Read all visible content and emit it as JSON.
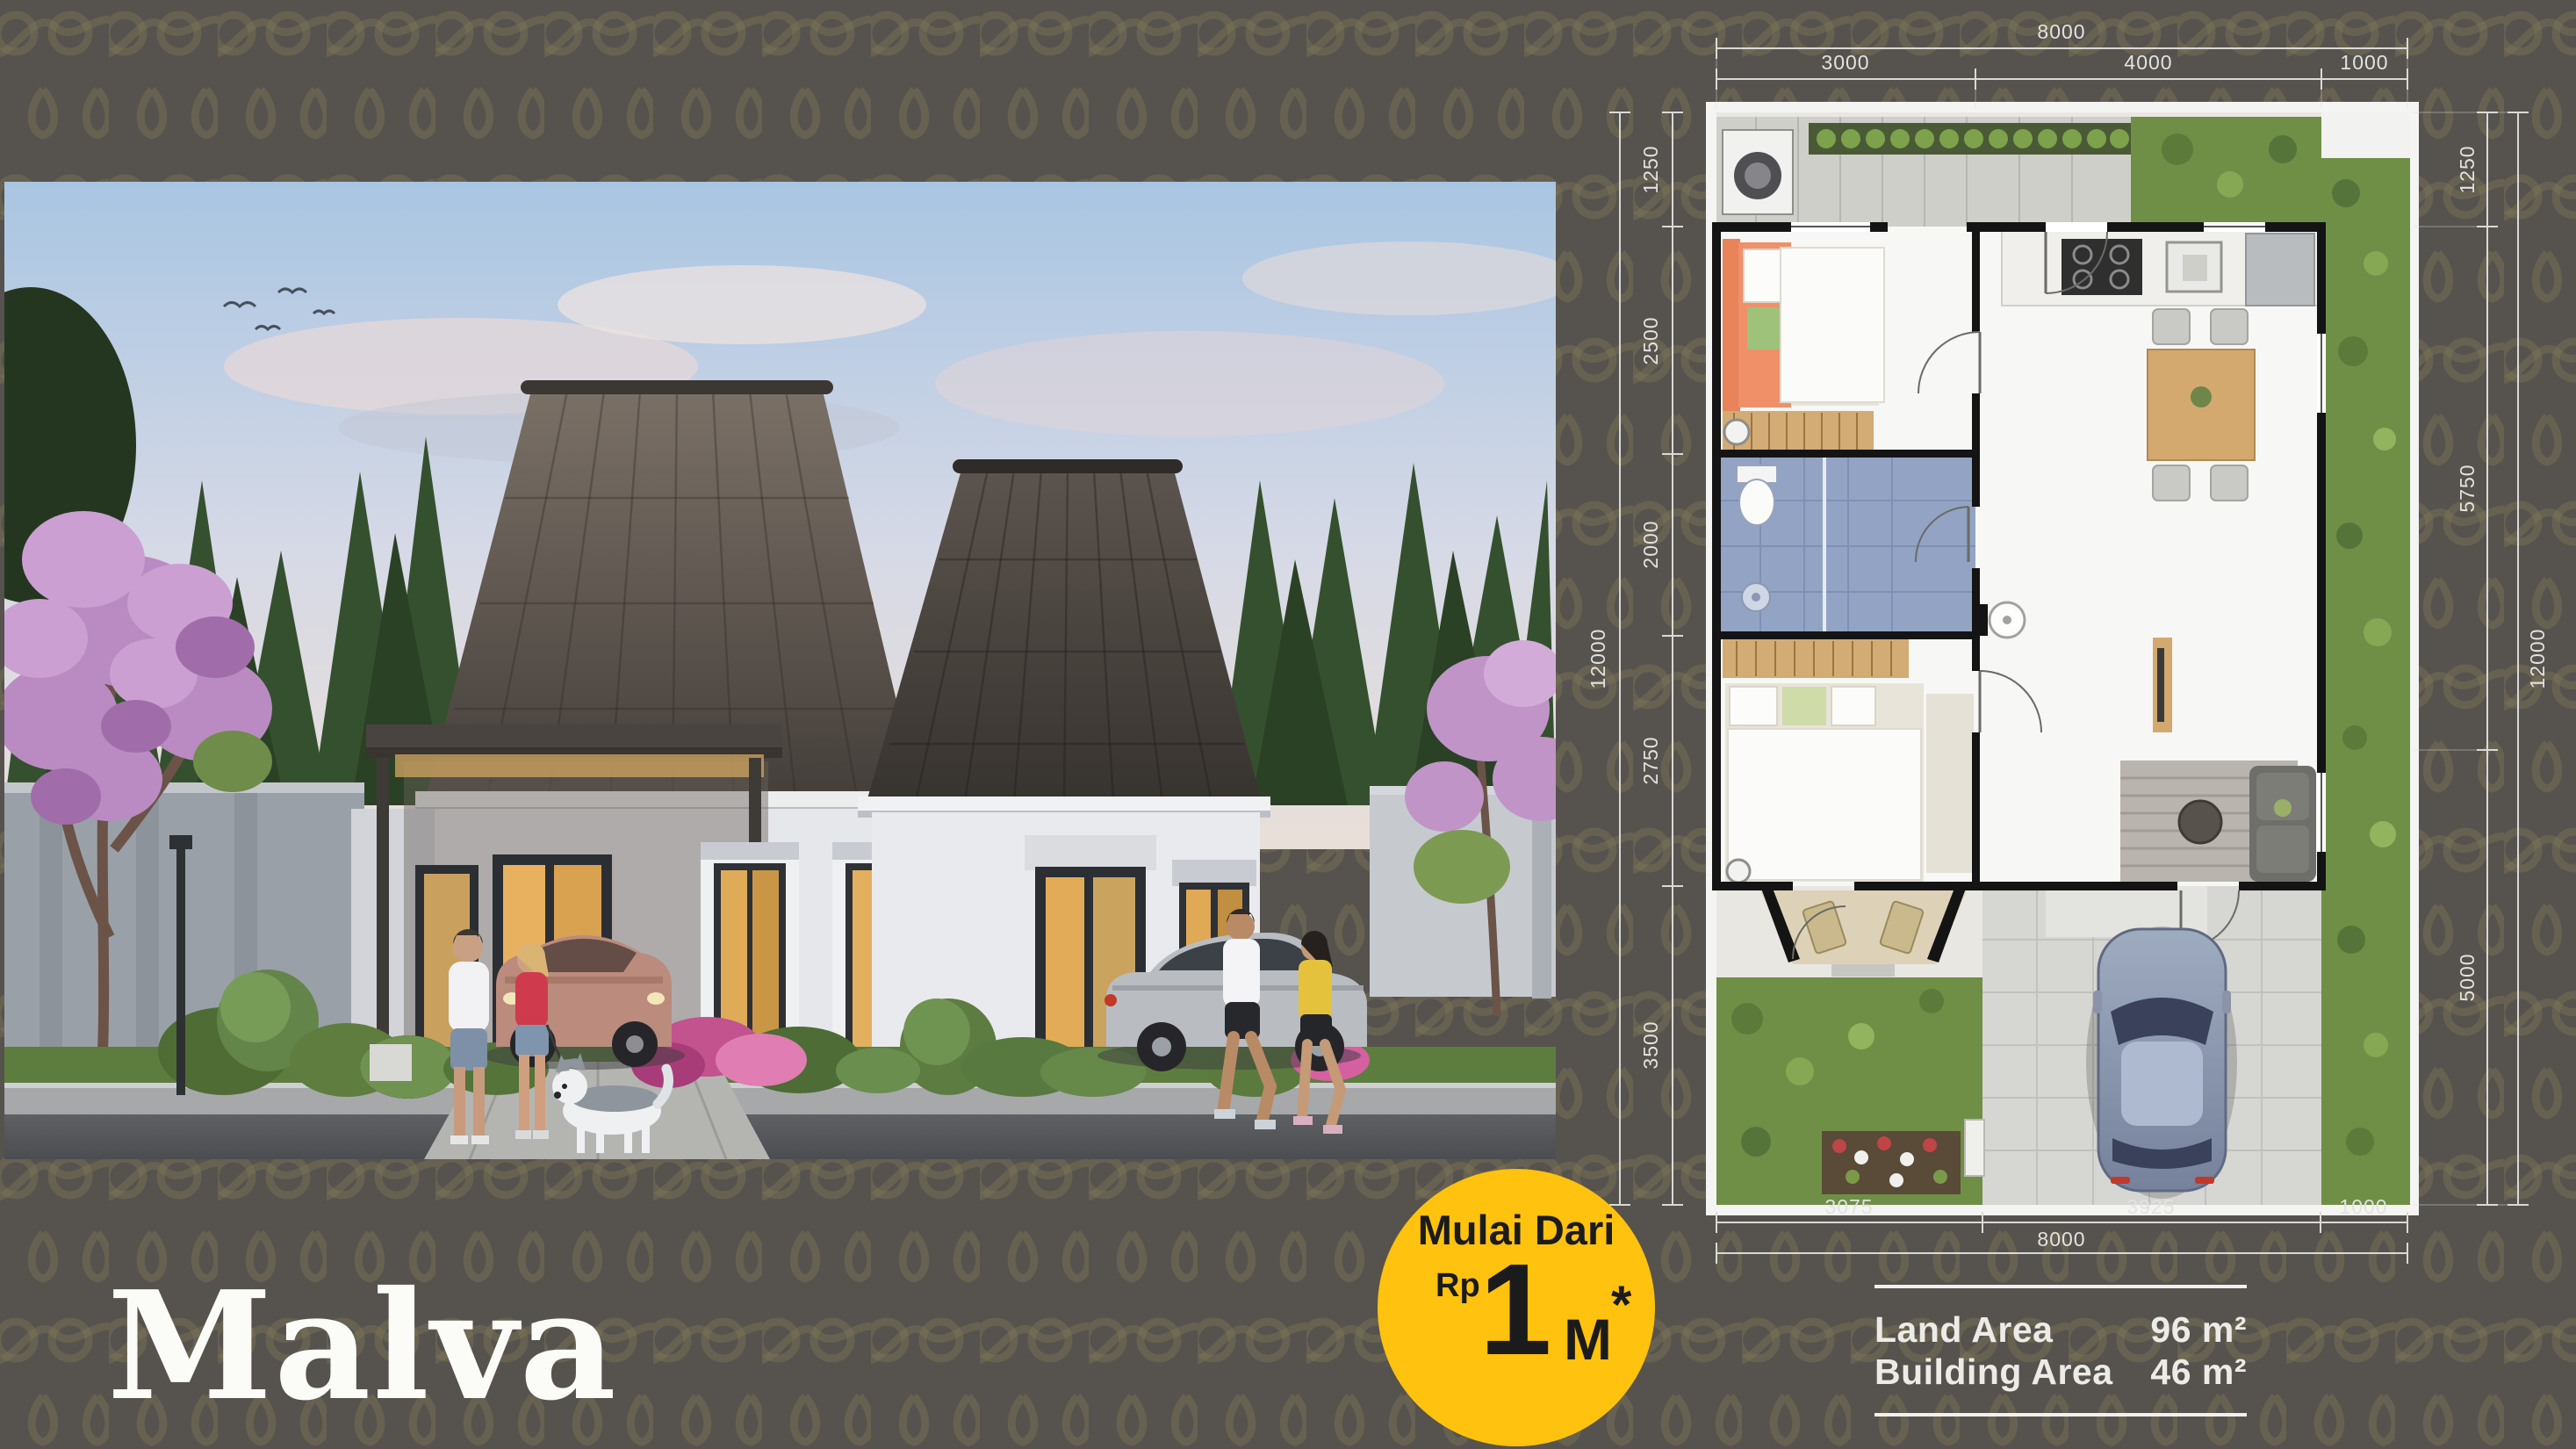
{
  "colors": {
    "background": "#56524D",
    "pattern_motif": "#8A7F5C",
    "accent_yellow": "#FFC20E",
    "badge_text": "#1B1B1B",
    "dimension_text": "#E2E2E0",
    "info_text": "#ECEBE7",
    "title_text": "#FBFBF8",
    "plan_wall": "#141414",
    "plan_garden": "#6F8F46",
    "plan_bathroom": "#93A3C4"
  },
  "title": {
    "text": "Malva"
  },
  "price_badge": {
    "line1": "Mulai Dari",
    "currency": "Rp",
    "amount": "1",
    "unit": "M",
    "note": "*"
  },
  "info_panel": {
    "rows": [
      {
        "label": "Land Area",
        "value": "96 m²"
      },
      {
        "label": "Building Area",
        "value": "46 m²"
      }
    ]
  },
  "floor_plan": {
    "dimensions": {
      "top": {
        "total": "8000",
        "segments": [
          "3000",
          "4000",
          "1000"
        ]
      },
      "bottom": {
        "total": "8000",
        "segments": [
          "3075",
          "3925",
          "1000"
        ]
      },
      "left": {
        "total": "12000",
        "segments": [
          "1250",
          "2500",
          "2000",
          "2750",
          "3500"
        ]
      },
      "right": {
        "total": "12000",
        "segments": [
          "1250",
          "5750",
          "5000"
        ]
      }
    }
  }
}
